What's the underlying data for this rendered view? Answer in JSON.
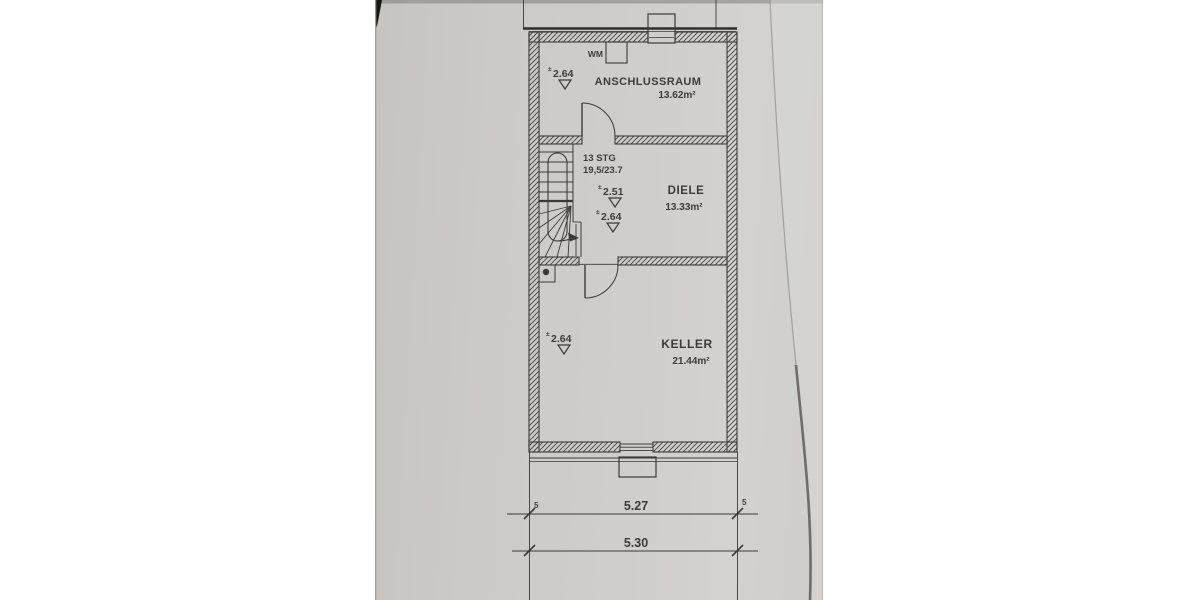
{
  "plan": {
    "rooms": [
      {
        "name": "ANSCHLUSSRAUM",
        "area": "13.62m²"
      },
      {
        "name": "DIELE",
        "area": "13.33m²"
      },
      {
        "name": "KELLER",
        "area": "21.44m²"
      }
    ],
    "stair_note": {
      "line1": "13 STG",
      "line2": "19,5/23.7"
    },
    "appliance_label": "WM",
    "datum_prefix": "±",
    "height_markers": {
      "anschlussraum": "2.64",
      "diele_upper": "2.51",
      "diele_lower": "2.64",
      "keller": "2.64"
    },
    "dimensions": {
      "inner_width": "5.27",
      "outer_width": "5.30",
      "wall_offset_left": "5",
      "wall_offset_right": "5"
    },
    "colors": {
      "paper": "#cdccc8",
      "ink": "#3b3a37"
    }
  }
}
